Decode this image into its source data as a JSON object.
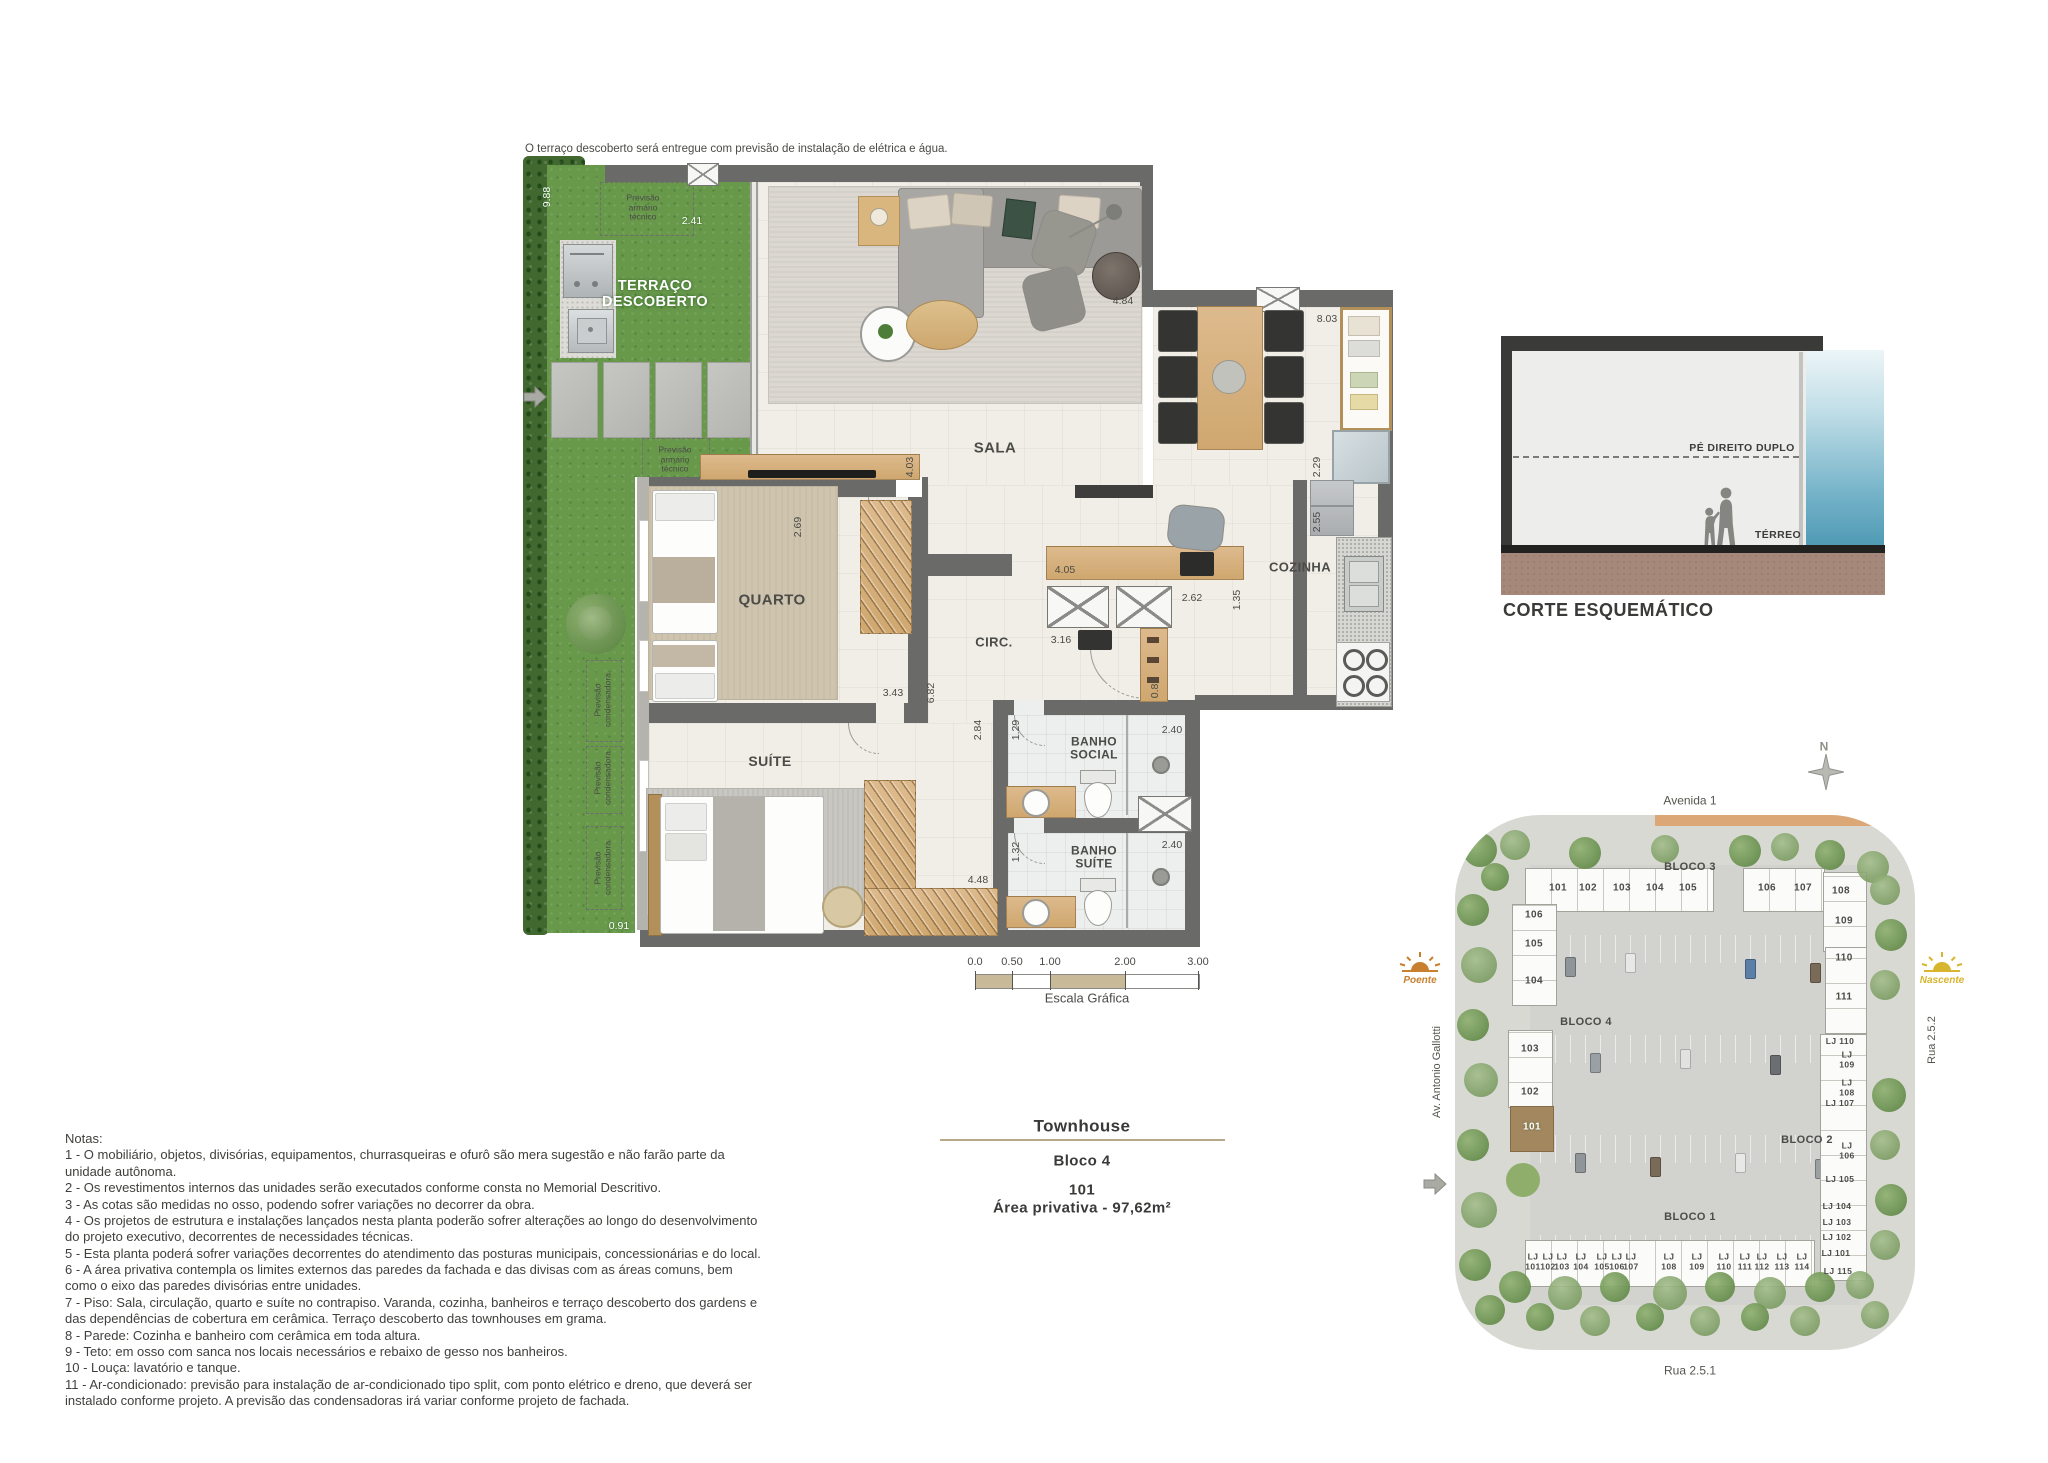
{
  "top_note": "O terraço descoberto será entregue com previsão de instalação de elétrica e água.",
  "title_block": {
    "title": "Townhouse",
    "block": "Bloco 4",
    "unit": "101",
    "area": "Área privativa - 97,62m²"
  },
  "corte": {
    "title": "CORTE ESQUEMÁTICO",
    "pe_direito": "PÉ DIREITO DUPLO",
    "terreo": "TÉRREO"
  },
  "scale_bar": {
    "label": "Escala Gráfica",
    "ticks": [
      {
        "t": "0.0",
        "x": 975
      },
      {
        "t": "0.50",
        "x": 1012
      },
      {
        "t": "1.00",
        "x": 1050
      },
      {
        "t": "2.00",
        "x": 1125
      },
      {
        "t": "3.00",
        "x": 1198
      }
    ]
  },
  "plan": {
    "room_labels": [
      {
        "t": "TERRAÇO\nDESCOBERTO",
        "x": 655,
        "y": 294,
        "s": 14.5,
        "cls": "white-room",
        "name": "room-label-terraco"
      },
      {
        "t": "SALA",
        "x": 995,
        "y": 449,
        "s": 15,
        "name": "room-label-sala"
      },
      {
        "t": "QUARTO",
        "x": 772,
        "y": 601,
        "s": 15,
        "name": "room-label-quarto"
      },
      {
        "t": "SUÍTE",
        "x": 770,
        "y": 762,
        "s": 14,
        "name": "room-label-suite"
      },
      {
        "t": "CIRC.",
        "x": 994,
        "y": 643,
        "s": 13,
        "name": "room-label-circ"
      },
      {
        "t": "COZINHA",
        "x": 1300,
        "y": 568,
        "s": 13,
        "name": "room-label-cozinha"
      },
      {
        "t": "BANHO\nSOCIAL",
        "x": 1094,
        "y": 749,
        "s": 12,
        "name": "room-label-banho-social"
      },
      {
        "t": "BANHO\nSUÍTE",
        "x": 1094,
        "y": 858,
        "s": 12,
        "name": "room-label-banho-suite"
      }
    ],
    "dimensions": [
      {
        "t": "9.88",
        "x": 548,
        "y": 197,
        "v": 1,
        "cls": "wdim"
      },
      {
        "t": "2.41",
        "x": 692,
        "y": 222,
        "cls": "wdim"
      },
      {
        "t": "0.91",
        "x": 619,
        "y": 927,
        "cls": "wdim"
      },
      {
        "t": "4.84",
        "x": 1123,
        "y": 302
      },
      {
        "t": "8.03",
        "x": 1327,
        "y": 320
      },
      {
        "t": "2.29",
        "x": 1318,
        "y": 467,
        "v": 1
      },
      {
        "t": "2.55",
        "x": 1318,
        "y": 522,
        "v": 1
      },
      {
        "t": "4.03",
        "x": 911,
        "y": 467,
        "v": 1
      },
      {
        "t": "2.69",
        "x": 799,
        "y": 527,
        "v": 1
      },
      {
        "t": "4.05",
        "x": 1065,
        "y": 571
      },
      {
        "t": "2.62",
        "x": 1192,
        "y": 599
      },
      {
        "t": "1.35",
        "x": 1238,
        "y": 600,
        "v": 1
      },
      {
        "t": "3.16",
        "x": 1061,
        "y": 641
      },
      {
        "t": "0.89",
        "x": 1156,
        "y": 688,
        "v": 1
      },
      {
        "t": "3.43",
        "x": 893,
        "y": 694
      },
      {
        "t": "6.82",
        "x": 932,
        "y": 693,
        "v": 1
      },
      {
        "t": "2.84",
        "x": 979,
        "y": 730,
        "v": 1
      },
      {
        "t": "1.29",
        "x": 1017,
        "y": 730,
        "v": 1
      },
      {
        "t": "2.40",
        "x": 1172,
        "y": 731
      },
      {
        "t": "1.32",
        "x": 1017,
        "y": 852,
        "v": 1
      },
      {
        "t": "2.40",
        "x": 1172,
        "y": 846
      },
      {
        "t": "4.48",
        "x": 978,
        "y": 881
      }
    ],
    "annotations": [
      {
        "t": "Previsão\narmário\ntécnico",
        "x": 643,
        "y": 208,
        "s": 8.5,
        "name": "annotation-armario-tecnico"
      },
      {
        "t": "Previsão\narmário\ntécnico",
        "x": 675,
        "y": 460,
        "s": 8.5,
        "name": "annotation-armario-tecnico"
      },
      {
        "t": "Previsão\ncondensadora",
        "x": 603,
        "y": 700,
        "v": 1,
        "s": 8.5,
        "w": 70,
        "name": "annotation-condensadora"
      },
      {
        "t": "Previsão\ncondensadora",
        "x": 603,
        "y": 778,
        "v": 1,
        "s": 8.5,
        "w": 64,
        "name": "annotation-condensadora"
      },
      {
        "t": "Previsão\ncondensadora",
        "x": 603,
        "y": 868,
        "v": 1,
        "s": 8.5,
        "w": 70,
        "name": "annotation-condensadora"
      }
    ]
  },
  "site_plan": {
    "streets": {
      "top": "Avenida 1",
      "left": "Av. Antonio Gallotti",
      "right": "Rua 2.5.2",
      "bottom": "Rua 2.5.1"
    },
    "compass_n": "N",
    "sun_west": "Poente",
    "sun_east": "Nascente",
    "bloco_labels": [
      {
        "t": "BLOCO 3",
        "x": 1690,
        "y": 867
      },
      {
        "t": "BLOCO 4",
        "x": 1586,
        "y": 1022
      },
      {
        "t": "BLOCO 2",
        "x": 1807,
        "y": 1140
      },
      {
        "t": "BLOCO 1",
        "x": 1690,
        "y": 1217
      }
    ],
    "units_top": [
      {
        "t": "101",
        "x": 1558,
        "y": 888
      },
      {
        "t": "102",
        "x": 1588,
        "y": 888
      },
      {
        "t": "103",
        "x": 1622,
        "y": 888
      },
      {
        "t": "104",
        "x": 1655,
        "y": 888
      },
      {
        "t": "105",
        "x": 1688,
        "y": 888
      },
      {
        "t": "106",
        "x": 1767,
        "y": 888
      },
      {
        "t": "107",
        "x": 1803,
        "y": 888
      },
      {
        "t": "108",
        "x": 1841,
        "y": 891
      }
    ],
    "units_left": [
      {
        "t": "106",
        "x": 1534,
        "y": 915
      },
      {
        "t": "105",
        "x": 1534,
        "y": 944
      },
      {
        "t": "104",
        "x": 1534,
        "y": 981
      },
      {
        "t": "103",
        "x": 1530,
        "y": 1049
      },
      {
        "t": "102",
        "x": 1530,
        "y": 1092
      },
      {
        "t": "101",
        "x": 1532,
        "y": 1127,
        "cls": "wdim"
      }
    ],
    "units_right": [
      {
        "t": "109",
        "x": 1844,
        "y": 921
      },
      {
        "t": "110",
        "x": 1844,
        "y": 958
      },
      {
        "t": "111",
        "x": 1844,
        "y": 997
      }
    ],
    "units_lj_right": [
      {
        "t": "LJ 110",
        "x": 1840,
        "y": 1042
      },
      {
        "t": "LJ\n109",
        "x": 1847,
        "y": 1060
      },
      {
        "t": "LJ\n108",
        "x": 1847,
        "y": 1088
      },
      {
        "t": "LJ 107",
        "x": 1840,
        "y": 1104
      },
      {
        "t": "LJ\n106",
        "x": 1847,
        "y": 1151
      },
      {
        "t": "LJ 105",
        "x": 1840,
        "y": 1180
      },
      {
        "t": "LJ 104",
        "x": 1837,
        "y": 1207
      },
      {
        "t": "LJ 103",
        "x": 1837,
        "y": 1223
      },
      {
        "t": "LJ 102",
        "x": 1837,
        "y": 1238
      },
      {
        "t": "LJ 101",
        "x": 1836,
        "y": 1254
      },
      {
        "t": "LJ 115",
        "x": 1838,
        "y": 1272
      }
    ],
    "units_bottom": [
      {
        "t": "LJ\n101",
        "x": 1533,
        "y": 1262
      },
      {
        "t": "LJ\n102",
        "x": 1548,
        "y": 1262
      },
      {
        "t": "LJ\n103",
        "x": 1562,
        "y": 1262
      },
      {
        "t": "LJ\n104",
        "x": 1581,
        "y": 1262
      },
      {
        "t": "LJ\n105",
        "x": 1602,
        "y": 1262
      },
      {
        "t": "LJ\n106",
        "x": 1617,
        "y": 1262
      },
      {
        "t": "LJ\n107",
        "x": 1631,
        "y": 1262
      },
      {
        "t": "LJ\n108",
        "x": 1669,
        "y": 1262
      },
      {
        "t": "LJ\n109",
        "x": 1697,
        "y": 1262
      },
      {
        "t": "LJ\n110",
        "x": 1724,
        "y": 1262
      },
      {
        "t": "LJ\n111",
        "x": 1745,
        "y": 1262
      },
      {
        "t": "LJ\n112",
        "x": 1762,
        "y": 1262
      },
      {
        "t": "LJ\n113",
        "x": 1782,
        "y": 1262
      },
      {
        "t": "LJ\n114",
        "x": 1802,
        "y": 1262
      }
    ],
    "highlight_unit": "101",
    "highlight_color": "#a3875f"
  },
  "notes": {
    "heading": "Notas:",
    "items": [
      "1 - O mobiliário, objetos, divisórias, equipamentos, churrasqueiras e ofurô são mera sugestão e não farão parte da unidade autônoma.",
      "2 - Os revestimentos internos das unidades serão executados conforme consta no Memorial Descritivo.",
      "3 - As cotas são medidas no osso, podendo sofrer variações no decorrer da obra.",
      "4 - Os projetos de estrutura e instalações lançados nesta planta poderão sofrer alterações ao longo do desenvolvimento do projeto executivo, decorrentes de necessidades técnicas.",
      "5 - Esta planta poderá sofrer variações decorrentes do atendimento das posturas municipais, concessionárias e do local.",
      "6 - A área privativa contempla os limites externos das paredes da fachada e das divisas com as áreas comuns, bem como o eixo das paredes divisórias entre unidades.",
      "7 - Piso: Sala, circulação, quarto e suíte no contrapiso. Varanda, cozinha, banheiros e terraço descoberto dos gardens e das dependências de cobertura em cerâmica. Terraço descoberto das townhouses em grama.",
      "8 - Parede: Cozinha e banheiro com cerâmica em toda altura.",
      "9 - Teto: em osso com sanca nos locais necessários e rebaixo de gesso nos banheiros.",
      "10 - Louça: lavatório e tanque.",
      "11 - Ar-condicionado: previsão para instalação de ar-condicionado tipo split, com ponto elétrico e dreno, que deverá ser instalado conforme projeto. A previsão das condensadoras irá variar conforme projeto de fachada."
    ]
  },
  "colors": {
    "wall": "#6a6a68",
    "grass": "#68994b",
    "wood": "#d2a873",
    "accent_line": "#b5a98a",
    "corte_ground": "#a5887a",
    "corte_sky": "#4f9ab4",
    "sun_west": "#c8802e",
    "sun_east": "#d8b52e"
  }
}
